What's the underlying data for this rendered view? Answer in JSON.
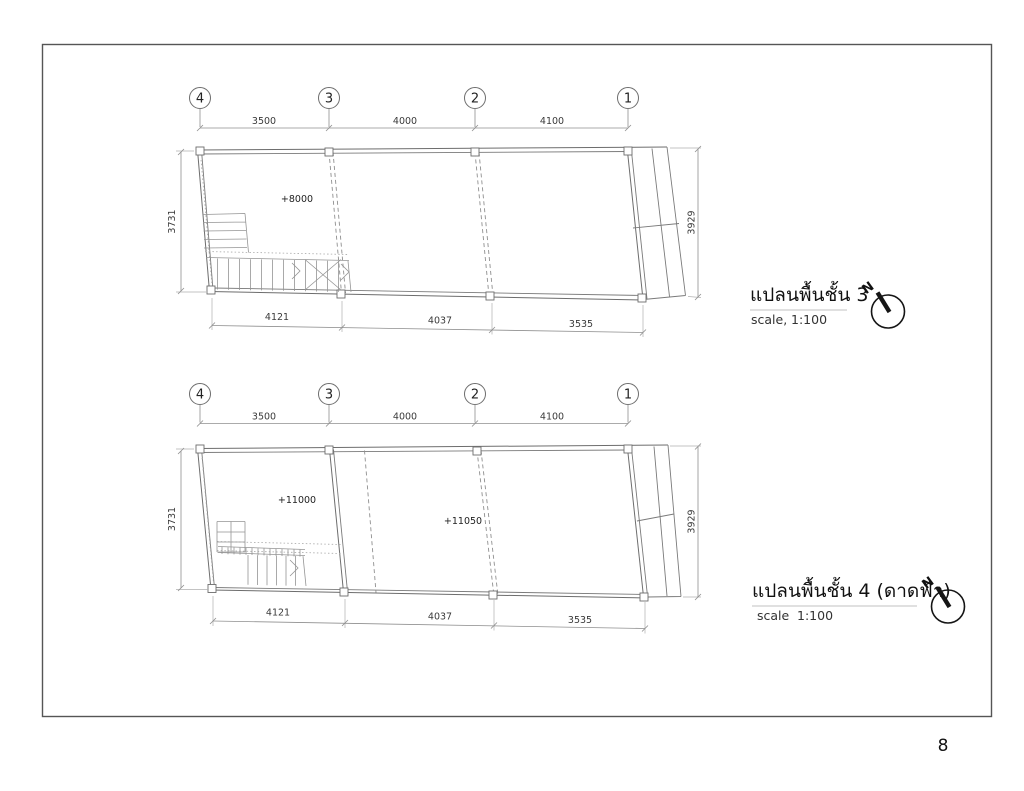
{
  "page": {
    "number": "8"
  },
  "colors": {
    "line": "#6d6d6d",
    "text": "#2b2b2b"
  },
  "plans": [
    {
      "title": "แปลนพื้นชั้น 3",
      "scale_label": "scale,",
      "scale_value": "1:100",
      "north_label": "N",
      "grids": [
        "4",
        "3",
        "2",
        "1"
      ],
      "top_dims": [
        "3500",
        "4000",
        "4100"
      ],
      "bottom_dims": [
        "4121",
        "4037",
        "3535"
      ],
      "left_dim": "3731",
      "right_dim": "3929",
      "levels": [
        "+8000"
      ]
    },
    {
      "title": "แปลนพื้นชั้น 4 (ดาดฟ้า)",
      "scale_label": "scale",
      "scale_value": "1:100",
      "north_label": "N",
      "grids": [
        "4",
        "3",
        "2",
        "1"
      ],
      "top_dims": [
        "3500",
        "4000",
        "4100"
      ],
      "bottom_dims": [
        "4121",
        "4037",
        "3535"
      ],
      "left_dim": "3731",
      "right_dim": "3929",
      "levels": [
        "+11000",
        "+11050"
      ]
    }
  ]
}
